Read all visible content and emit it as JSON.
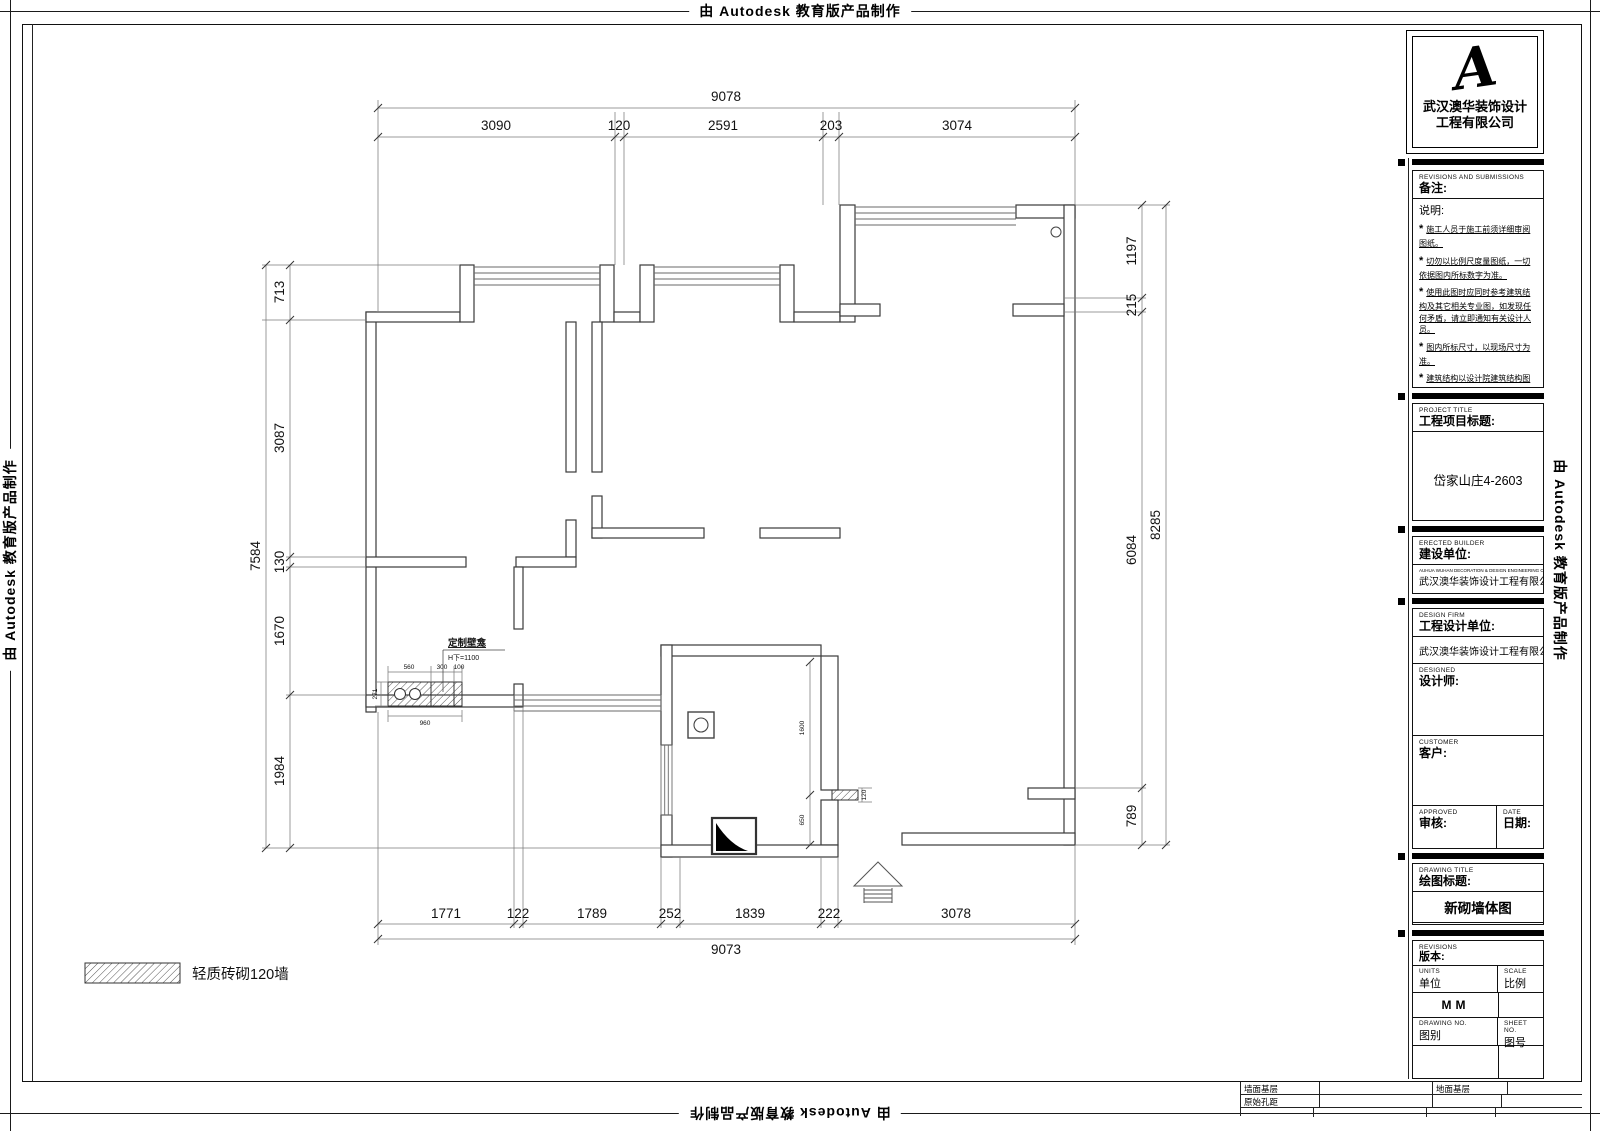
{
  "watermark": {
    "text": "由 Autodesk 教育版产品制作"
  },
  "title_block": {
    "logo_letter": "A",
    "logo_company_line1": "武汉澳华装饰设计",
    "logo_company_line2": "工程有限公司",
    "revisions_header_en": "REVISIONS AND SUBMISSIONS",
    "remarks_label": "备注:",
    "notes_title": "说明:",
    "note_bullet": "*",
    "notes": [
      "施工人员于施工前须详细审阅图纸。",
      "切勿以比例尺度量图纸，一切依据图内所标数字为准。",
      "使用此图时应同时参考建筑结构及其它相关专业图，如发现任何矛盾，请立即通知有关设计人员。",
      "图内所标尺寸，以现场尺寸为准。",
      "建筑结构以设计院建筑结构图为准。",
      "未加盖本公司设计图章不准在施工中使用。"
    ],
    "project_title_en": "PROJECT TITLE",
    "project_title_label": "工程项目标题:",
    "project_title_value": "岱家山庄4-2603",
    "builder_en": "ERECTED BUILDER",
    "builder_label": "建设单位:",
    "builder_company_en": "AUHUA WUHAN DECORATION & DESIGN ENGINEERING CO.,LTD",
    "builder_value": "武汉澳华装饰设计工程有限公司",
    "design_firm_en": "DESIGN FIRM",
    "design_firm_label": "工程设计单位:",
    "design_firm_value": "武汉澳华装饰设计工程有限公司",
    "designed_en": "DESIGNED",
    "designed_label": "设计师:",
    "customer_en": "CUSTOMER",
    "customer_label": "客户:",
    "approved_en": "APPROVED",
    "approved_label": "审核:",
    "date_en": "DATE",
    "date_label": "日期:",
    "drawing_title_en": "DRAWING TITLE",
    "drawing_title_label": "绘图标题:",
    "drawing_title_value": "新砌墙体图",
    "revisions_en": "REVISIONS",
    "revisions_label": "版本:",
    "units_en": "UNITS",
    "units_label": "单位",
    "units_value": "MM",
    "scale_en": "SCALE",
    "scale_label": "比例",
    "drawing_no_en": "DRAWING NO.",
    "drawing_no_label": "图别",
    "sheet_no_en": "SHEET NO.",
    "sheet_no_label": "图号"
  },
  "footer": {
    "cells": [
      "墙面基层",
      "原始孔距",
      "地面基层"
    ]
  },
  "legend": {
    "label": "轻质砖砌120墙"
  },
  "plan": {
    "dims_top": {
      "overall": "9078",
      "segments": [
        "3090",
        "120",
        "2591",
        "203",
        "3074"
      ]
    },
    "dims_bottom": {
      "overall": "9073",
      "segments": [
        "1771",
        "122",
        "1789",
        "252",
        "1839",
        "222",
        "3078"
      ]
    },
    "dims_left": {
      "overall": "7584",
      "segments": [
        "713",
        "3087",
        "130",
        "1670",
        "1984"
      ]
    },
    "dims_right": {
      "overall": "8285",
      "segments": [
        "1197",
        "215",
        "6084",
        "789"
      ]
    },
    "niche": {
      "label": "定制壁龛",
      "height_note": "H下=1100",
      "seg1": "560",
      "seg2": "300",
      "seg3": "100",
      "width_total": "960",
      "depth": "271"
    },
    "bath": {
      "v1": "1600",
      "v2": "650",
      "wall": "120"
    }
  }
}
